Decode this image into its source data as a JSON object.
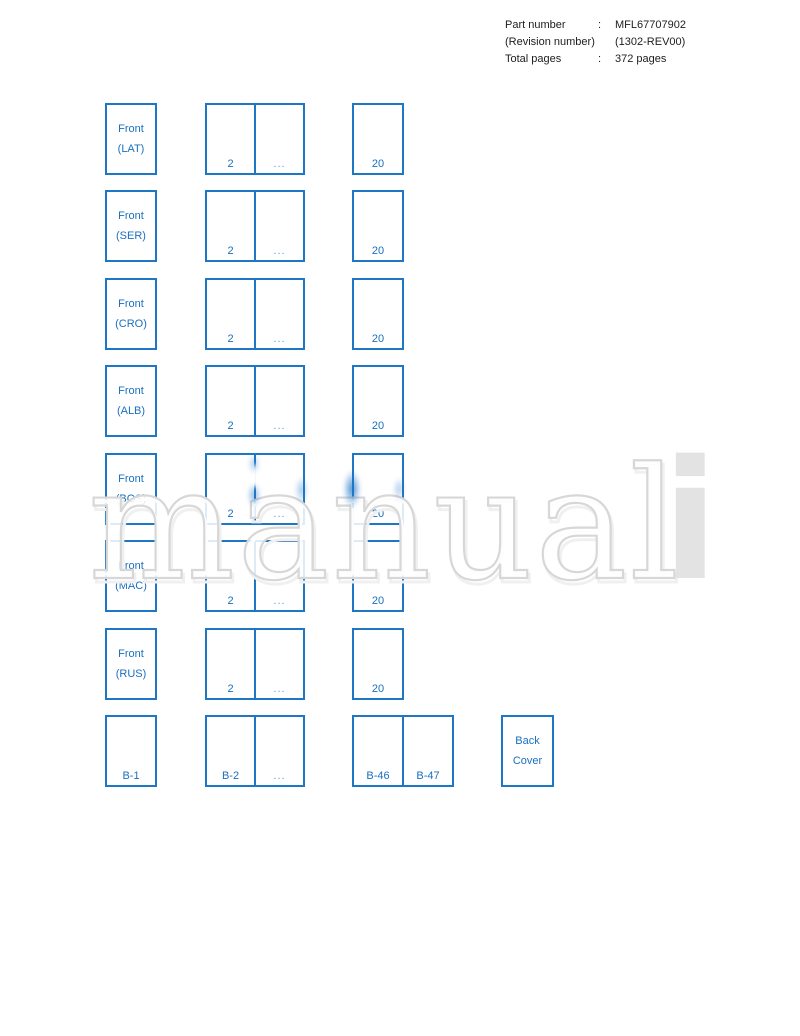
{
  "header": {
    "rows": [
      {
        "label": "Part number",
        "separator": ":",
        "value": "MFL67707902"
      },
      {
        "label": "(Revision number)",
        "separator": "",
        "value": "(1302-REV00)"
      },
      {
        "label": "Total pages",
        "separator": ":",
        "value": "372 pages"
      }
    ]
  },
  "grid": {
    "language_rows": [
      {
        "cover_line1": "Front",
        "cover_line2": "(LAT)",
        "spread_first_page": "2",
        "spread_more": "...",
        "last_page": "20"
      },
      {
        "cover_line1": "Front",
        "cover_line2": "(SER)",
        "spread_first_page": "2",
        "spread_more": "...",
        "last_page": "20"
      },
      {
        "cover_line1": "Front",
        "cover_line2": "(CRO)",
        "spread_first_page": "2",
        "spread_more": "...",
        "last_page": "20"
      },
      {
        "cover_line1": "Front",
        "cover_line2": "(ALB)",
        "spread_first_page": "2",
        "spread_more": "...",
        "last_page": "20"
      },
      {
        "cover_line1": "Front",
        "cover_line2": "(BOS)",
        "spread_first_page": "2",
        "spread_more": "...",
        "last_page": "20"
      },
      {
        "cover_line1": "Front",
        "cover_line2": "(MAC)",
        "spread_first_page": "2",
        "spread_more": "...",
        "last_page": "20"
      },
      {
        "cover_line1": "Front",
        "cover_line2": "(RUS)",
        "spread_first_page": "2",
        "spread_more": "...",
        "last_page": "20"
      }
    ],
    "back_row": {
      "first_page": "B-1",
      "spread_first_page": "B-2",
      "spread_more": "...",
      "final_spread_left": "B-46",
      "final_spread_right": "B-47",
      "back_cover_line1": "Back",
      "back_cover_line2": "Cover"
    }
  },
  "watermark": {
    "outlined_text": "manual",
    "solid_letter": "i"
  },
  "colors": {
    "box_border": "#1e77c4",
    "label_text": "#1a6fbe",
    "header_text": "#1d1d1d",
    "watermark_outline": "#d7d7d7",
    "watermark_solid": "#e3e3e3",
    "smudge_blue": "#1f75c5"
  }
}
